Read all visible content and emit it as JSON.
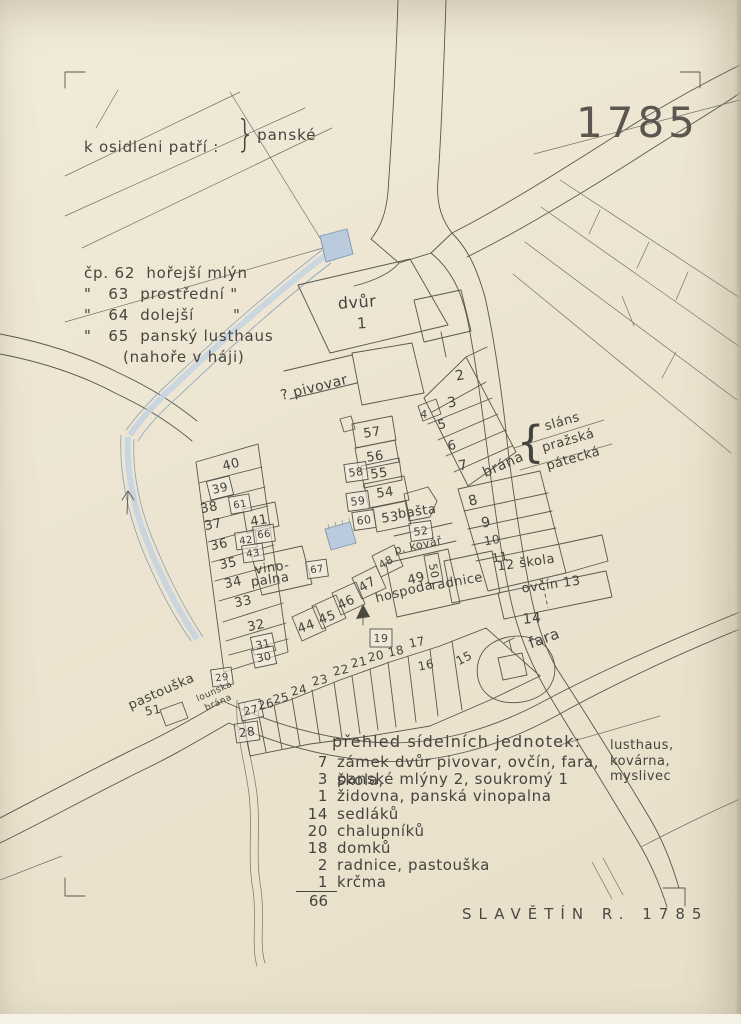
{
  "stamp_year": "1785",
  "caption": "SLAVĚTÍN  R.  1785",
  "notes": {
    "title": "k osidleni patří :",
    "lines": [
      "čp. 62  hořejší mlýn",
      "\"   63  prostřední \"",
      "\"   64  dolejší       \"",
      "\"   65  panský lusthaus",
      "       (nahoře v háji)"
    ],
    "brace_label": "panské"
  },
  "legend": {
    "header": "přehled sídelních jednotek:",
    "side_notes": [
      "lusthaus,",
      "kovárna,",
      "myslivec"
    ],
    "rows": [
      {
        "count": "7",
        "text": "zámek dvůr pivovar, ovčín, fara, škola,"
      },
      {
        "count": "3",
        "text": "panské mlýny 2, soukromý 1"
      },
      {
        "count": "1",
        "text": "židovna, panská vinopalna"
      },
      {
        "count": "14",
        "text": "sedláků"
      },
      {
        "count": "20",
        "text": "chalupníků"
      },
      {
        "count": "18",
        "text": "domků"
      },
      {
        "count": "2",
        "text": "radnice, pastouška"
      },
      {
        "count": "1",
        "text": "krčma"
      }
    ],
    "total": "66"
  },
  "map": {
    "ink_color": "#5a564e",
    "water_color": "#b9cbdd",
    "labels": [
      {
        "id": "dvur",
        "t": "dvůr",
        "x": 357,
        "y": 302,
        "r": -4,
        "s": 16
      },
      {
        "id": "dvur-1",
        "t": "1",
        "x": 362,
        "y": 323,
        "r": -4,
        "s": 15
      },
      {
        "id": "pivovar",
        "t": "? pivovar",
        "x": 314,
        "y": 387,
        "r": -14,
        "s": 14
      },
      {
        "id": "n2",
        "t": "2",
        "x": 460,
        "y": 375,
        "r": -12,
        "s": 14
      },
      {
        "id": "n3",
        "t": "3",
        "x": 452,
        "y": 402,
        "r": -12,
        "s": 14
      },
      {
        "id": "n4",
        "t": "4",
        "x": 424,
        "y": 414,
        "r": 0,
        "s": 11
      },
      {
        "id": "n5",
        "t": "5",
        "x": 442,
        "y": 424,
        "r": -12,
        "s": 13
      },
      {
        "id": "n6",
        "t": "6",
        "x": 452,
        "y": 445,
        "r": -12,
        "s": 13
      },
      {
        "id": "n7",
        "t": "7",
        "x": 463,
        "y": 465,
        "r": -12,
        "s": 14
      },
      {
        "id": "brana-east",
        "t": "brána",
        "x": 503,
        "y": 464,
        "r": -24,
        "s": 14
      },
      {
        "id": "brace",
        "t": "{",
        "x": 531,
        "y": 441,
        "r": 0,
        "s": 44
      },
      {
        "id": "slans",
        "t": "sláns",
        "x": 562,
        "y": 421,
        "r": -16,
        "s": 13
      },
      {
        "id": "prazska",
        "t": "pražská",
        "x": 568,
        "y": 440,
        "r": -16,
        "s": 13
      },
      {
        "id": "patecka",
        "t": "pátecká",
        "x": 573,
        "y": 458,
        "r": -16,
        "s": 13
      },
      {
        "id": "n8",
        "t": "8",
        "x": 473,
        "y": 500,
        "r": -14,
        "s": 14
      },
      {
        "id": "n9",
        "t": "9",
        "x": 486,
        "y": 522,
        "r": -12,
        "s": 14
      },
      {
        "id": "n10",
        "t": "10",
        "x": 492,
        "y": 540,
        "r": -10,
        "s": 12
      },
      {
        "id": "n11",
        "t": "11",
        "x": 500,
        "y": 557,
        "r": -10,
        "s": 12
      },
      {
        "id": "n12-skola",
        "t": "12 škola",
        "x": 526,
        "y": 562,
        "r": -8,
        "s": 13
      },
      {
        "id": "ovcin-13",
        "t": "ovčín 13",
        "x": 551,
        "y": 584,
        "r": -8,
        "s": 13
      },
      {
        "id": "n14",
        "t": "14",
        "x": 532,
        "y": 618,
        "r": -6,
        "s": 14
      },
      {
        "id": "fara",
        "t": "fara",
        "x": 544,
        "y": 638,
        "r": -20,
        "s": 15
      },
      {
        "id": "n57",
        "t": "57",
        "x": 372,
        "y": 432,
        "r": -8,
        "s": 13
      },
      {
        "id": "n56",
        "t": "56",
        "x": 375,
        "y": 456,
        "r": -8,
        "s": 13
      },
      {
        "id": "n55",
        "t": "55",
        "x": 379,
        "y": 473,
        "r": -8,
        "s": 13
      },
      {
        "id": "n58",
        "t": "58",
        "x": 356,
        "y": 472,
        "r": -8,
        "s": 11,
        "box": true
      },
      {
        "id": "n54",
        "t": "54",
        "x": 385,
        "y": 492,
        "r": -8,
        "s": 13
      },
      {
        "id": "n59",
        "t": "59",
        "x": 358,
        "y": 501,
        "r": -8,
        "s": 11,
        "box": true
      },
      {
        "id": "n60",
        "t": "60",
        "x": 364,
        "y": 520,
        "r": -8,
        "s": 11,
        "box": true
      },
      {
        "id": "n53",
        "t": "53",
        "x": 390,
        "y": 517,
        "r": -8,
        "s": 13
      },
      {
        "id": "basta",
        "t": "bašta",
        "x": 417,
        "y": 511,
        "r": -8,
        "s": 13
      },
      {
        "id": "n52",
        "t": "52",
        "x": 421,
        "y": 531,
        "r": -8,
        "s": 11,
        "box": true
      },
      {
        "id": "p-kovar",
        "t": "p. kovář",
        "x": 418,
        "y": 545,
        "r": -12,
        "s": 11
      },
      {
        "id": "n61",
        "t": "61",
        "x": 240,
        "y": 504,
        "r": -10,
        "s": 10,
        "box": true
      },
      {
        "id": "n41",
        "t": "41",
        "x": 259,
        "y": 520,
        "r": -10,
        "s": 13
      },
      {
        "id": "n42",
        "t": "42",
        "x": 246,
        "y": 540,
        "r": -8,
        "s": 10,
        "box": true
      },
      {
        "id": "n66",
        "t": "66",
        "x": 264,
        "y": 534,
        "r": -8,
        "s": 10,
        "box": true
      },
      {
        "id": "n43",
        "t": "43",
        "x": 253,
        "y": 553,
        "r": -8,
        "s": 10,
        "box": true
      },
      {
        "id": "vino-1",
        "t": "vino-",
        "x": 272,
        "y": 567,
        "r": -8,
        "s": 13
      },
      {
        "id": "vino-2",
        "t": "palna",
        "x": 270,
        "y": 579,
        "r": -8,
        "s": 13
      },
      {
        "id": "n67",
        "t": "67",
        "x": 317,
        "y": 569,
        "r": -8,
        "s": 10,
        "box": true
      },
      {
        "id": "n40",
        "t": "40",
        "x": 231,
        "y": 464,
        "r": -14,
        "s": 13
      },
      {
        "id": "n39",
        "t": "39",
        "x": 220,
        "y": 488,
        "r": -14,
        "s": 12,
        "box": true
      },
      {
        "id": "n38",
        "t": "38",
        "x": 209,
        "y": 507,
        "r": -12,
        "s": 13
      },
      {
        "id": "n37",
        "t": "37",
        "x": 213,
        "y": 524,
        "r": -12,
        "s": 13
      },
      {
        "id": "n36",
        "t": "36",
        "x": 219,
        "y": 544,
        "r": -12,
        "s": 13
      },
      {
        "id": "n35",
        "t": "35",
        "x": 228,
        "y": 563,
        "r": -12,
        "s": 13
      },
      {
        "id": "n34",
        "t": "34",
        "x": 233,
        "y": 582,
        "r": -12,
        "s": 13
      },
      {
        "id": "n33",
        "t": "33",
        "x": 243,
        "y": 601,
        "r": -12,
        "s": 13
      },
      {
        "id": "n32",
        "t": "32",
        "x": 256,
        "y": 625,
        "r": -12,
        "s": 13
      },
      {
        "id": "n31",
        "t": "31",
        "x": 263,
        "y": 644,
        "r": -12,
        "s": 11,
        "box": true
      },
      {
        "id": "n30",
        "t": "30",
        "x": 264,
        "y": 657,
        "r": -12,
        "s": 11,
        "box": true
      },
      {
        "id": "n44",
        "t": "44",
        "x": 306,
        "y": 626,
        "r": -20,
        "s": 13
      },
      {
        "id": "n45",
        "t": "45",
        "x": 327,
        "y": 617,
        "r": -20,
        "s": 13
      },
      {
        "id": "n46",
        "t": "46",
        "x": 346,
        "y": 602,
        "r": -25,
        "s": 13
      },
      {
        "id": "n47",
        "t": "47",
        "x": 367,
        "y": 584,
        "r": -30,
        "s": 13
      },
      {
        "id": "n48",
        "t": "48",
        "x": 386,
        "y": 562,
        "r": -30,
        "s": 11
      },
      {
        "id": "n49",
        "t": "49",
        "x": 416,
        "y": 578,
        "r": -14,
        "s": 13
      },
      {
        "id": "hospoda",
        "t": "hospoda",
        "x": 404,
        "y": 591,
        "r": -14,
        "s": 13
      },
      {
        "id": "n50",
        "t": "50",
        "x": 434,
        "y": 571,
        "r": 80,
        "s": 11
      },
      {
        "id": "radnice",
        "t": "radnice",
        "x": 457,
        "y": 581,
        "r": -10,
        "s": 13
      },
      {
        "id": "n27",
        "t": "27",
        "x": 251,
        "y": 710,
        "r": -12,
        "s": 11,
        "box": true
      },
      {
        "id": "n26",
        "t": "26",
        "x": 266,
        "y": 704,
        "r": -12,
        "s": 12
      },
      {
        "id": "n25",
        "t": "25",
        "x": 281,
        "y": 698,
        "r": -12,
        "s": 12
      },
      {
        "id": "n24",
        "t": "24",
        "x": 299,
        "y": 690,
        "r": -12,
        "s": 12
      },
      {
        "id": "n23",
        "t": "23",
        "x": 320,
        "y": 680,
        "r": -12,
        "s": 12
      },
      {
        "id": "n22",
        "t": "22",
        "x": 341,
        "y": 670,
        "r": -12,
        "s": 12
      },
      {
        "id": "n21",
        "t": "21",
        "x": 359,
        "y": 662,
        "r": -12,
        "s": 12
      },
      {
        "id": "n20",
        "t": "20",
        "x": 376,
        "y": 656,
        "r": -12,
        "s": 12
      },
      {
        "id": "n19",
        "t": "19",
        "x": 381,
        "y": 638,
        "r": 0,
        "s": 11,
        "box": true
      },
      {
        "id": "n18",
        "t": "18",
        "x": 396,
        "y": 651,
        "r": -12,
        "s": 12
      },
      {
        "id": "n17",
        "t": "17",
        "x": 417,
        "y": 642,
        "r": -12,
        "s": 12
      },
      {
        "id": "n16",
        "t": "16",
        "x": 426,
        "y": 665,
        "r": -12,
        "s": 12
      },
      {
        "id": "n15",
        "t": "15",
        "x": 464,
        "y": 658,
        "r": -28,
        "s": 12
      },
      {
        "id": "n28",
        "t": "28",
        "x": 247,
        "y": 732,
        "r": -8,
        "s": 12,
        "box": true
      },
      {
        "id": "n29",
        "t": "29",
        "x": 222,
        "y": 677,
        "r": -8,
        "s": 10,
        "box": true
      },
      {
        "id": "lounska",
        "t": "lounská",
        "x": 214,
        "y": 691,
        "r": -24,
        "s": 9
      },
      {
        "id": "brana-louny",
        "t": "brána",
        "x": 218,
        "y": 702,
        "r": -24,
        "s": 9
      },
      {
        "id": "pastouska",
        "t": "pastouška",
        "x": 161,
        "y": 691,
        "r": -24,
        "s": 13
      },
      {
        "id": "n51",
        "t": "51",
        "x": 153,
        "y": 710,
        "r": -12,
        "s": 12
      }
    ]
  }
}
